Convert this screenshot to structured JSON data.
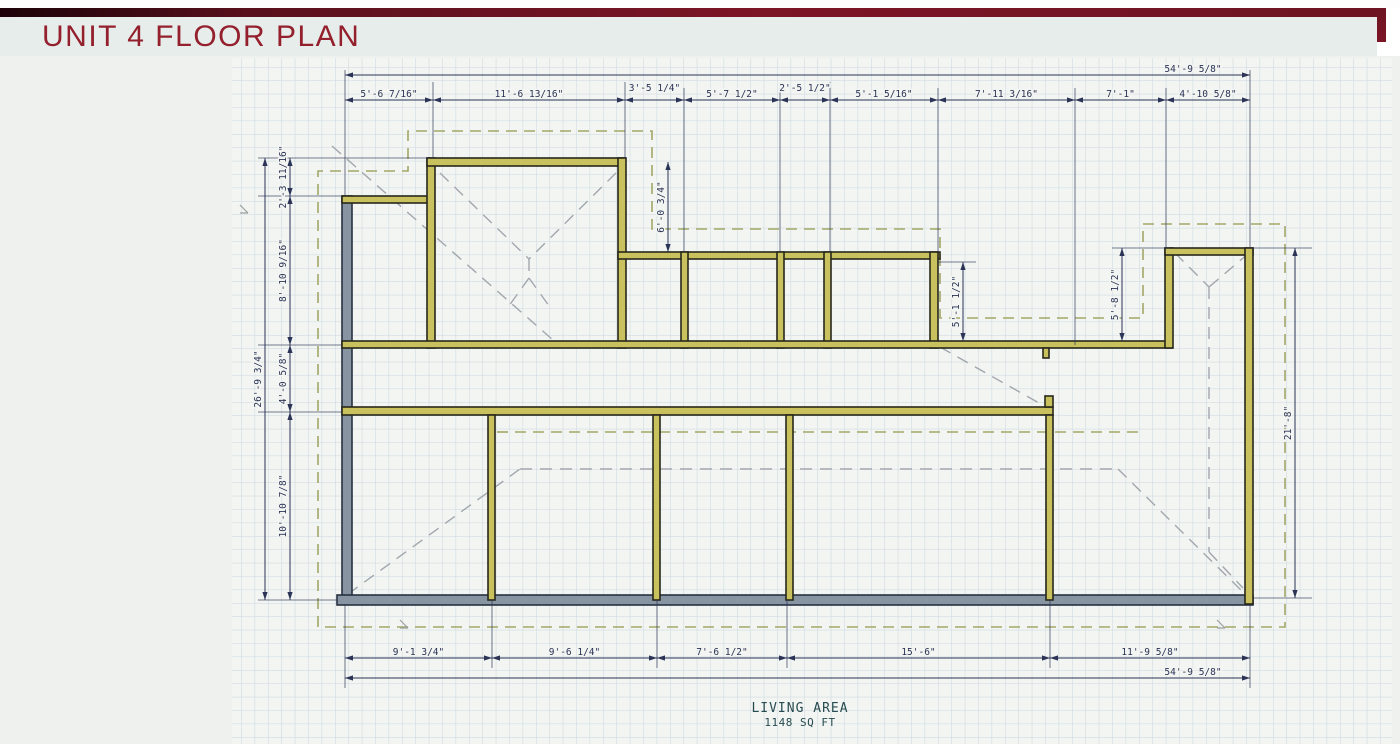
{
  "header": {
    "title": "UNIT 4 FLOOR PLAN"
  },
  "plan": {
    "top_overall": "54'-9 5/8\"",
    "top_dims": [
      "5'-6 7/16\"",
      "11'-6 13/16\"",
      "3'-5 1/4\"",
      "5'-7 1/2\"",
      "2'-5 1/2\"",
      "5'-1 5/16\"",
      "7'-11 3/16\"",
      "7'-1\"",
      "4'-10 5/8\""
    ],
    "bottom_dims": [
      "9'-1 3/4\"",
      "9'-6 1/4\"",
      "7'-6 1/2\"",
      "15'-6\"",
      "11'-9 5/8\""
    ],
    "bottom_overall": "54'-9 5/8\"",
    "left_overall": "26'-9 3/4\"",
    "left_dims": [
      "2'-3 11/16\"",
      "8'-10 9/16\"",
      "4'-0 5/8\"",
      "10'-10 7/8\""
    ],
    "right_dim": "21'-8\"",
    "interior_dims": [
      "6'-0 3/4\"",
      "5'-1 1/2\"",
      "5'-8 1/2\""
    ],
    "living_area_label": "LIVING AREA",
    "living_area_value": "1148 SQ FT"
  },
  "colors": {
    "accent_maroon": "#7c1526",
    "title_text": "#94202e",
    "wall_olive": "#c8c15e",
    "wall_gray": "#8795a3",
    "dimension": "#2b3356",
    "overhang_dash": "#a3a767",
    "roof_dash": "#a2a7ae",
    "grid_line": "#ccd8e2",
    "drawing_bg": "#f2f5f1"
  }
}
